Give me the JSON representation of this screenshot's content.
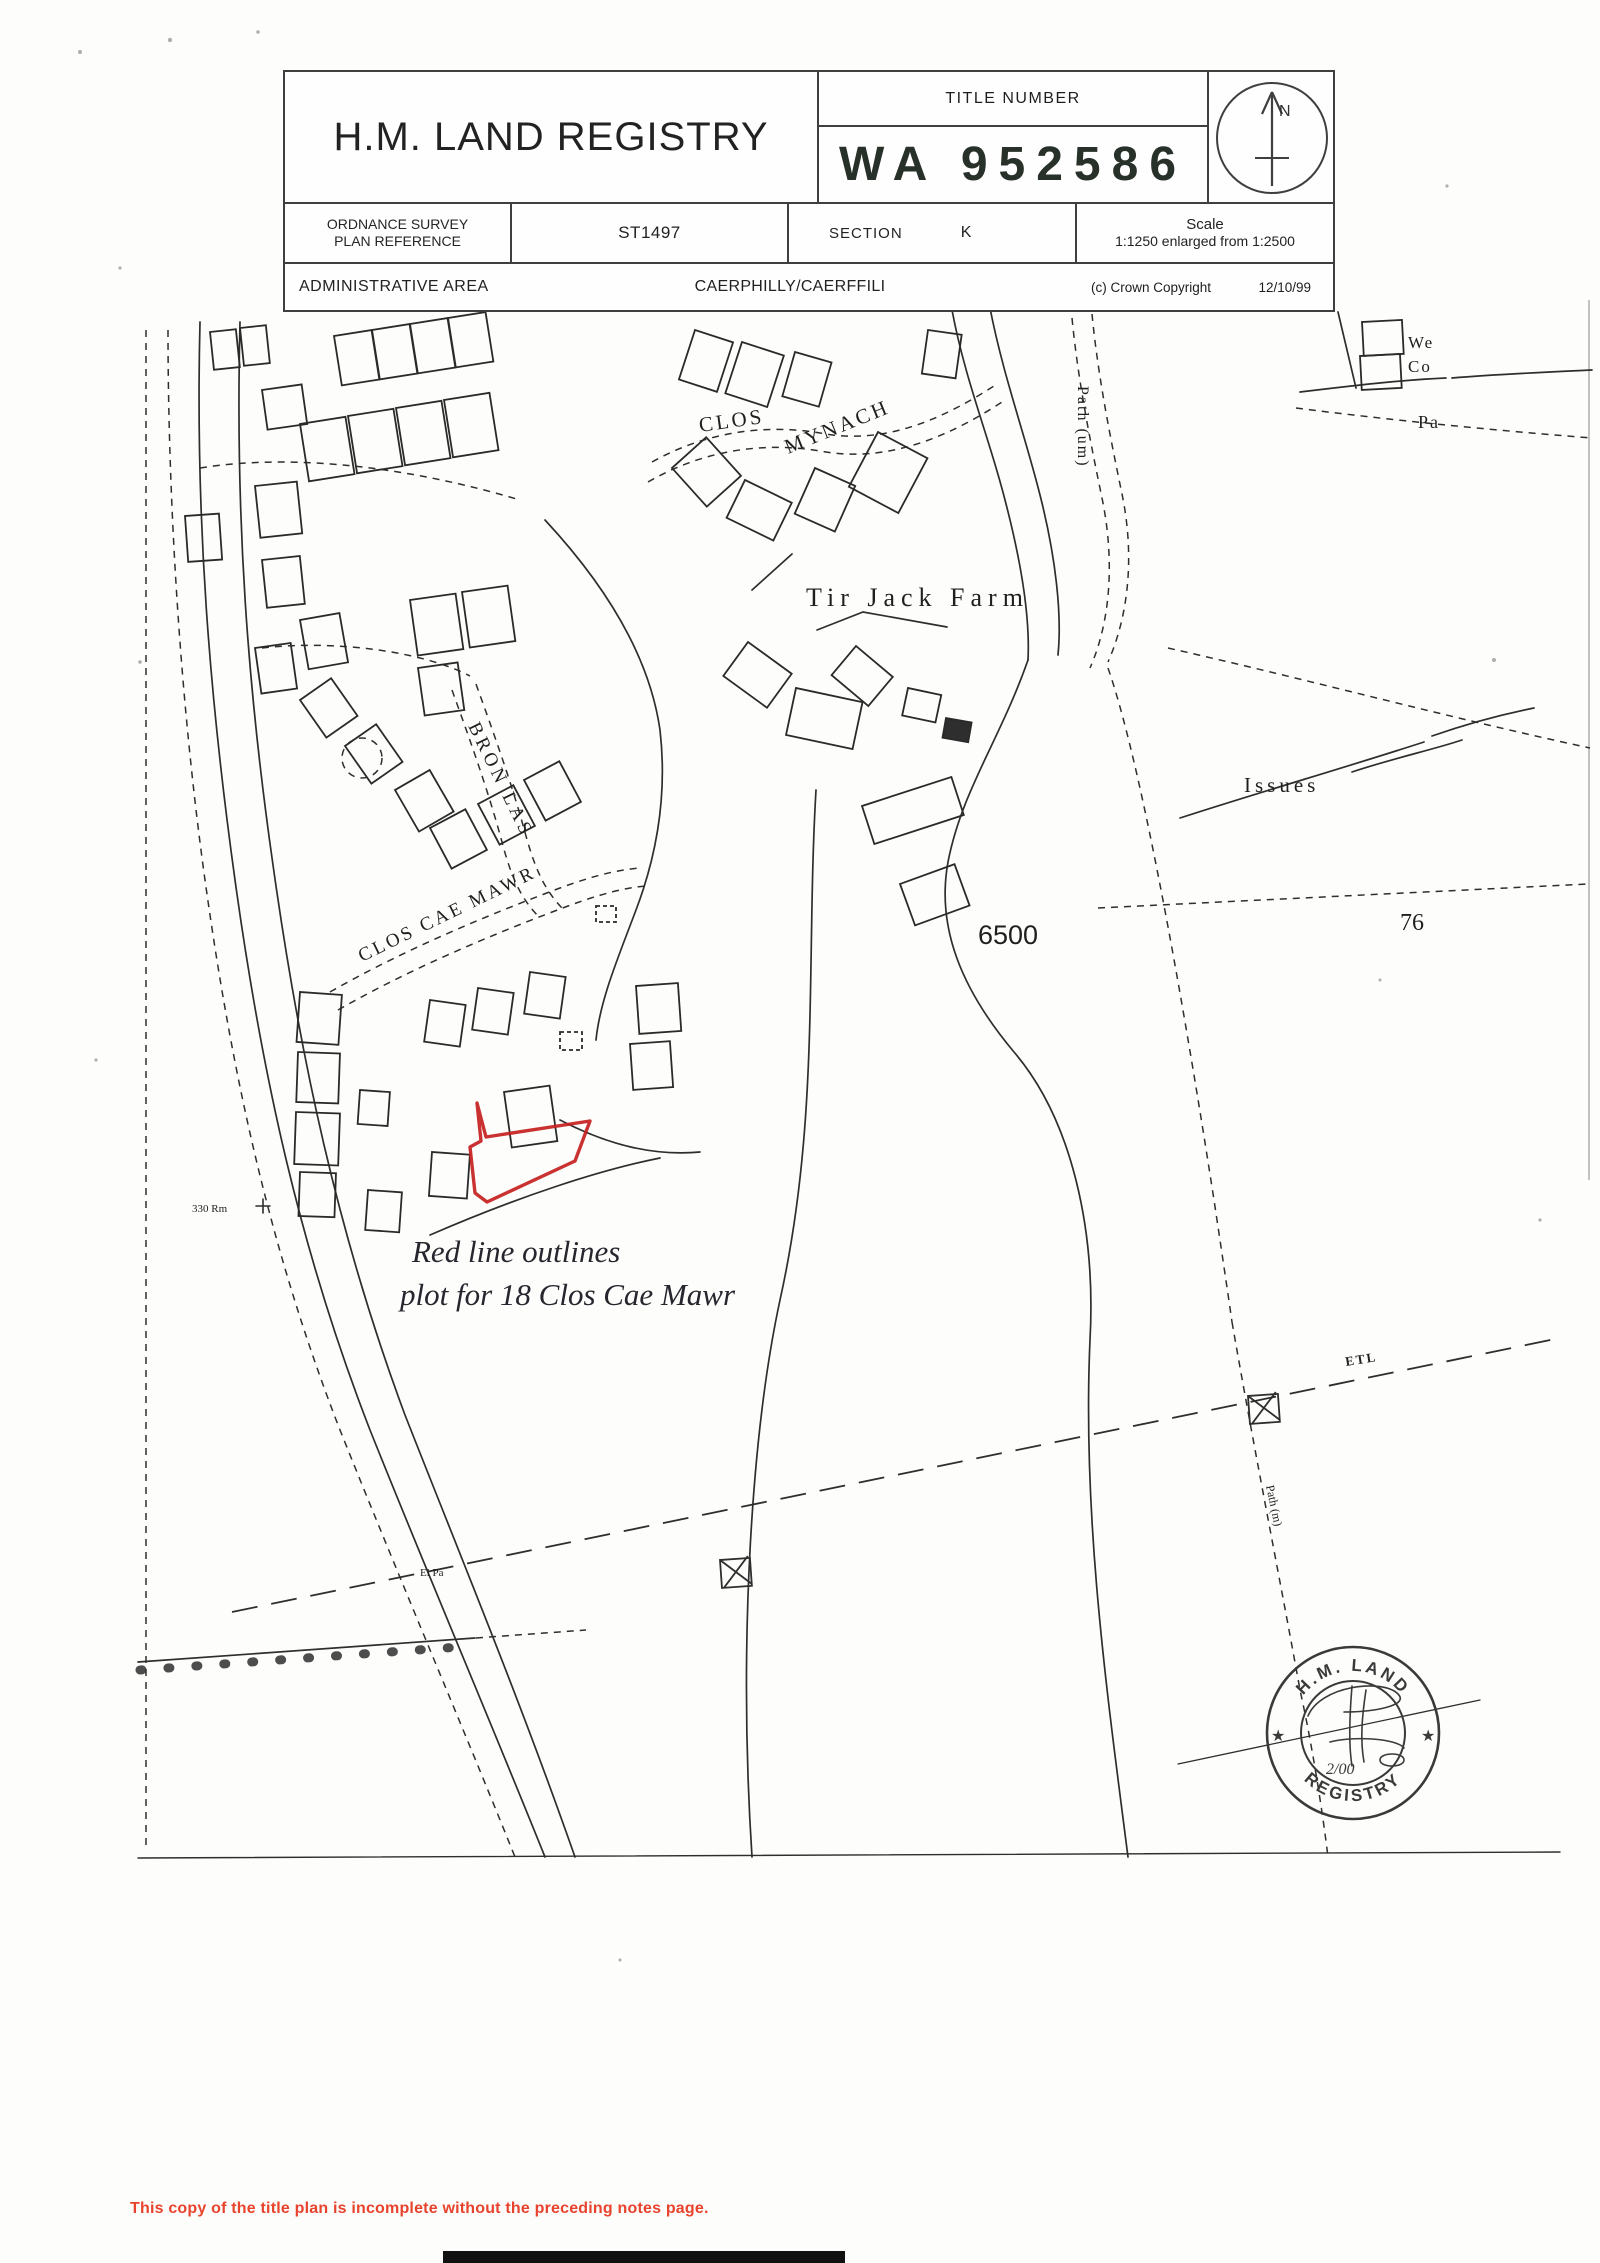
{
  "header": {
    "registry_title": "H.M. LAND REGISTRY",
    "title_number_label": "TITLE NUMBER",
    "title_number_value": "WA 952586",
    "north_label": "N",
    "os_ref_line1": "ORDNANCE SURVEY",
    "os_ref_line2": "PLAN REFERENCE",
    "os_ref_value": "ST1497",
    "section_label": "SECTION",
    "section_value": "K",
    "scale_label": "Scale",
    "scale_value": "1:1250 enlarged from 1:2500",
    "admin_label": "ADMINISTRATIVE AREA",
    "admin_value": "CAERPHILLY/CAERFFILI",
    "copyright_label": "(c) Crown Copyright",
    "copyright_date": "12/10/99"
  },
  "map": {
    "labels": {
      "clos": "CLOS",
      "mynach": "MYNACH",
      "tir_jack_farm": "Tir Jack Farm",
      "bron_las": "BRON LAS",
      "clos_cae_mawr": "CLOS CAE MAWR",
      "issues": "Issues",
      "parcel_6500": "6500",
      "parcel_76": "76",
      "path_um": "Path (um)",
      "path_m": "Path (m)",
      "etl": "ETL",
      "bench_mark": "330 Rm",
      "el_pa": "El Pa",
      "we": "We",
      "co": "Co",
      "pa": "Pa"
    },
    "annotation": {
      "line1": "Red line outlines",
      "line2": "plot for 18 Clos Cae Mawr"
    },
    "red_outline_color": "#c51f1f",
    "stamp": {
      "top_arc": "H.M. LAND",
      "bottom_arc": "REGISTRY",
      "star_left": "★",
      "star_right": "★",
      "note": "2/00"
    }
  },
  "footer": {
    "warning": "This copy of the title plan is incomplete without the preceding notes page.",
    "warning_color": "#e8432d"
  }
}
